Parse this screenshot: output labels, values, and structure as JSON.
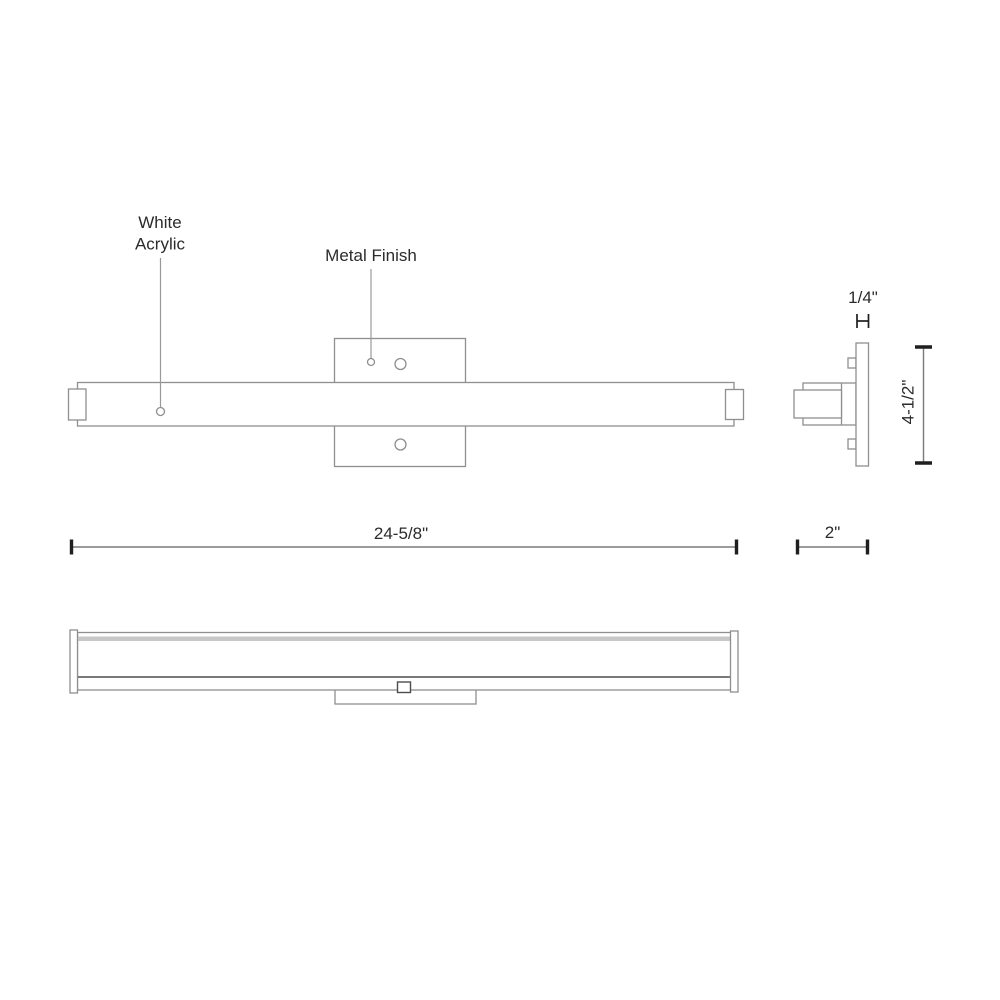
{
  "labels": {
    "white_acrylic": {
      "line1": "White",
      "line2": "Acrylic"
    },
    "metal_finish": "Metal Finish"
  },
  "dimensions": {
    "overall_width": "24-5/8\"",
    "depth": "2\"",
    "height": "4-1/2\"",
    "plate_thickness": "1/4\""
  },
  "colors": {
    "background": "#ffffff",
    "outline": "#8f8f8f",
    "outline_dark": "#4d4d4d",
    "band": "#c7c7c7",
    "leader": "#999999",
    "dim_line": "#7a7a7a",
    "tick": "#1f1f1f",
    "text": "#2b2b2b"
  }
}
